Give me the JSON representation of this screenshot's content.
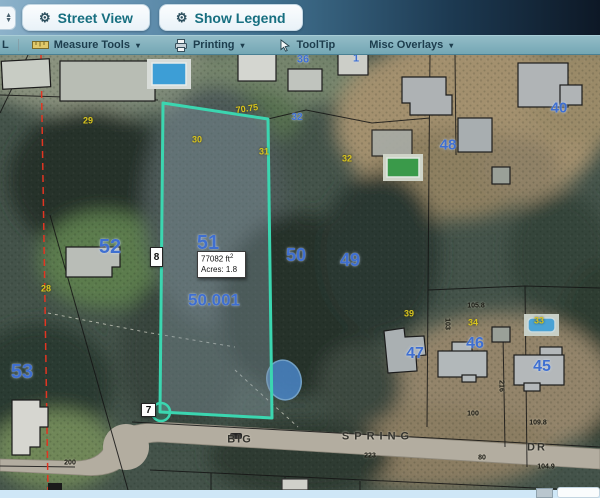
{
  "topbar": {
    "buttons": [
      {
        "label": "Street View"
      },
      {
        "label": "Show Legend"
      }
    ]
  },
  "menubar": {
    "partial_left": "L",
    "items": [
      {
        "label": "Measure Tools",
        "icon": "ruler-icon",
        "dropdown": true
      },
      {
        "label": "Printing",
        "icon": "printer-icon",
        "dropdown": true
      },
      {
        "label": "ToolTip",
        "icon": "cursor-icon",
        "dropdown": false
      },
      {
        "label": "Misc Overlays",
        "icon": null,
        "dropdown": true
      }
    ],
    "dropdown_glyph": "▾"
  },
  "map": {
    "tooltip": {
      "area_value": "77082",
      "area_unit": "ft",
      "area_sup": "2",
      "acres": "Acres: 1.8"
    },
    "selection": {
      "vertex_top": "8",
      "vertex_bottom": "7"
    },
    "parcel_labels": [
      {
        "text": "52",
        "x": 110,
        "y": 192,
        "size": 20
      },
      {
        "text": "51",
        "x": 208,
        "y": 188,
        "size": 20
      },
      {
        "text": "50",
        "x": 296,
        "y": 200,
        "size": 18
      },
      {
        "text": "49",
        "x": 350,
        "y": 205,
        "size": 18
      },
      {
        "text": "53",
        "x": 22,
        "y": 317,
        "size": 20
      },
      {
        "text": "50.001",
        "x": 214,
        "y": 245,
        "size": 17
      },
      {
        "text": "48",
        "x": 448,
        "y": 90,
        "size": 15
      },
      {
        "text": "40",
        "x": 559,
        "y": 53,
        "size": 15
      },
      {
        "text": "47",
        "x": 415,
        "y": 299,
        "size": 16
      },
      {
        "text": "46",
        "x": 475,
        "y": 289,
        "size": 16
      },
      {
        "text": "45",
        "x": 542,
        "y": 312,
        "size": 16
      },
      {
        "text": "32",
        "x": 297,
        "y": 63,
        "size": 10
      },
      {
        "text": "36",
        "x": 303,
        "y": 5,
        "size": 11
      },
      {
        "text": "1",
        "x": 356,
        "y": 4,
        "size": 11
      }
    ],
    "small_labels": [
      {
        "text": "29",
        "x": 88,
        "y": 66
      },
      {
        "text": "30",
        "x": 197,
        "y": 85
      },
      {
        "text": "31",
        "x": 264,
        "y": 97
      },
      {
        "text": "32",
        "x": 347,
        "y": 104
      },
      {
        "text": "28",
        "x": 46,
        "y": 234
      },
      {
        "text": "39",
        "x": 409,
        "y": 259
      },
      {
        "text": "34",
        "x": 473,
        "y": 268
      },
      {
        "text": "33",
        "x": 539,
        "y": 266
      },
      {
        "text": "70.75",
        "x": 247,
        "y": 54,
        "rot": -8
      }
    ],
    "dim_labels": [
      {
        "text": "100",
        "x": 473,
        "y": 359
      },
      {
        "text": "109.8",
        "x": 538,
        "y": 368
      },
      {
        "text": "104.9",
        "x": 546,
        "y": 412
      },
      {
        "text": "216",
        "x": 501,
        "y": 331,
        "rot": 90
      },
      {
        "text": "103",
        "x": 447,
        "y": 269,
        "rot": 90
      },
      {
        "text": "105.8",
        "x": 476,
        "y": 251
      },
      {
        "text": "223",
        "x": 370,
        "y": 401
      },
      {
        "text": "80",
        "x": 482,
        "y": 403
      },
      {
        "text": "200",
        "x": 70,
        "y": 408
      }
    ],
    "street_labels": [
      {
        "text": "BIG",
        "x": 240,
        "y": 385,
        "ls": 2
      },
      {
        "text": "SPRING",
        "x": 378,
        "y": 382,
        "ls": 5
      },
      {
        "text": "DR",
        "x": 537,
        "y": 393,
        "ls": 2
      }
    ]
  },
  "colors": {
    "selected_parcel_outline": "#3bd6b0",
    "parcel_number_blue": "#3f6fd0",
    "dimension_yellow": "#d8c41e",
    "section_line_red": "#e23522",
    "toolbar_teal": "#74a7b4",
    "footer_blue": "#cfe7f7"
  }
}
